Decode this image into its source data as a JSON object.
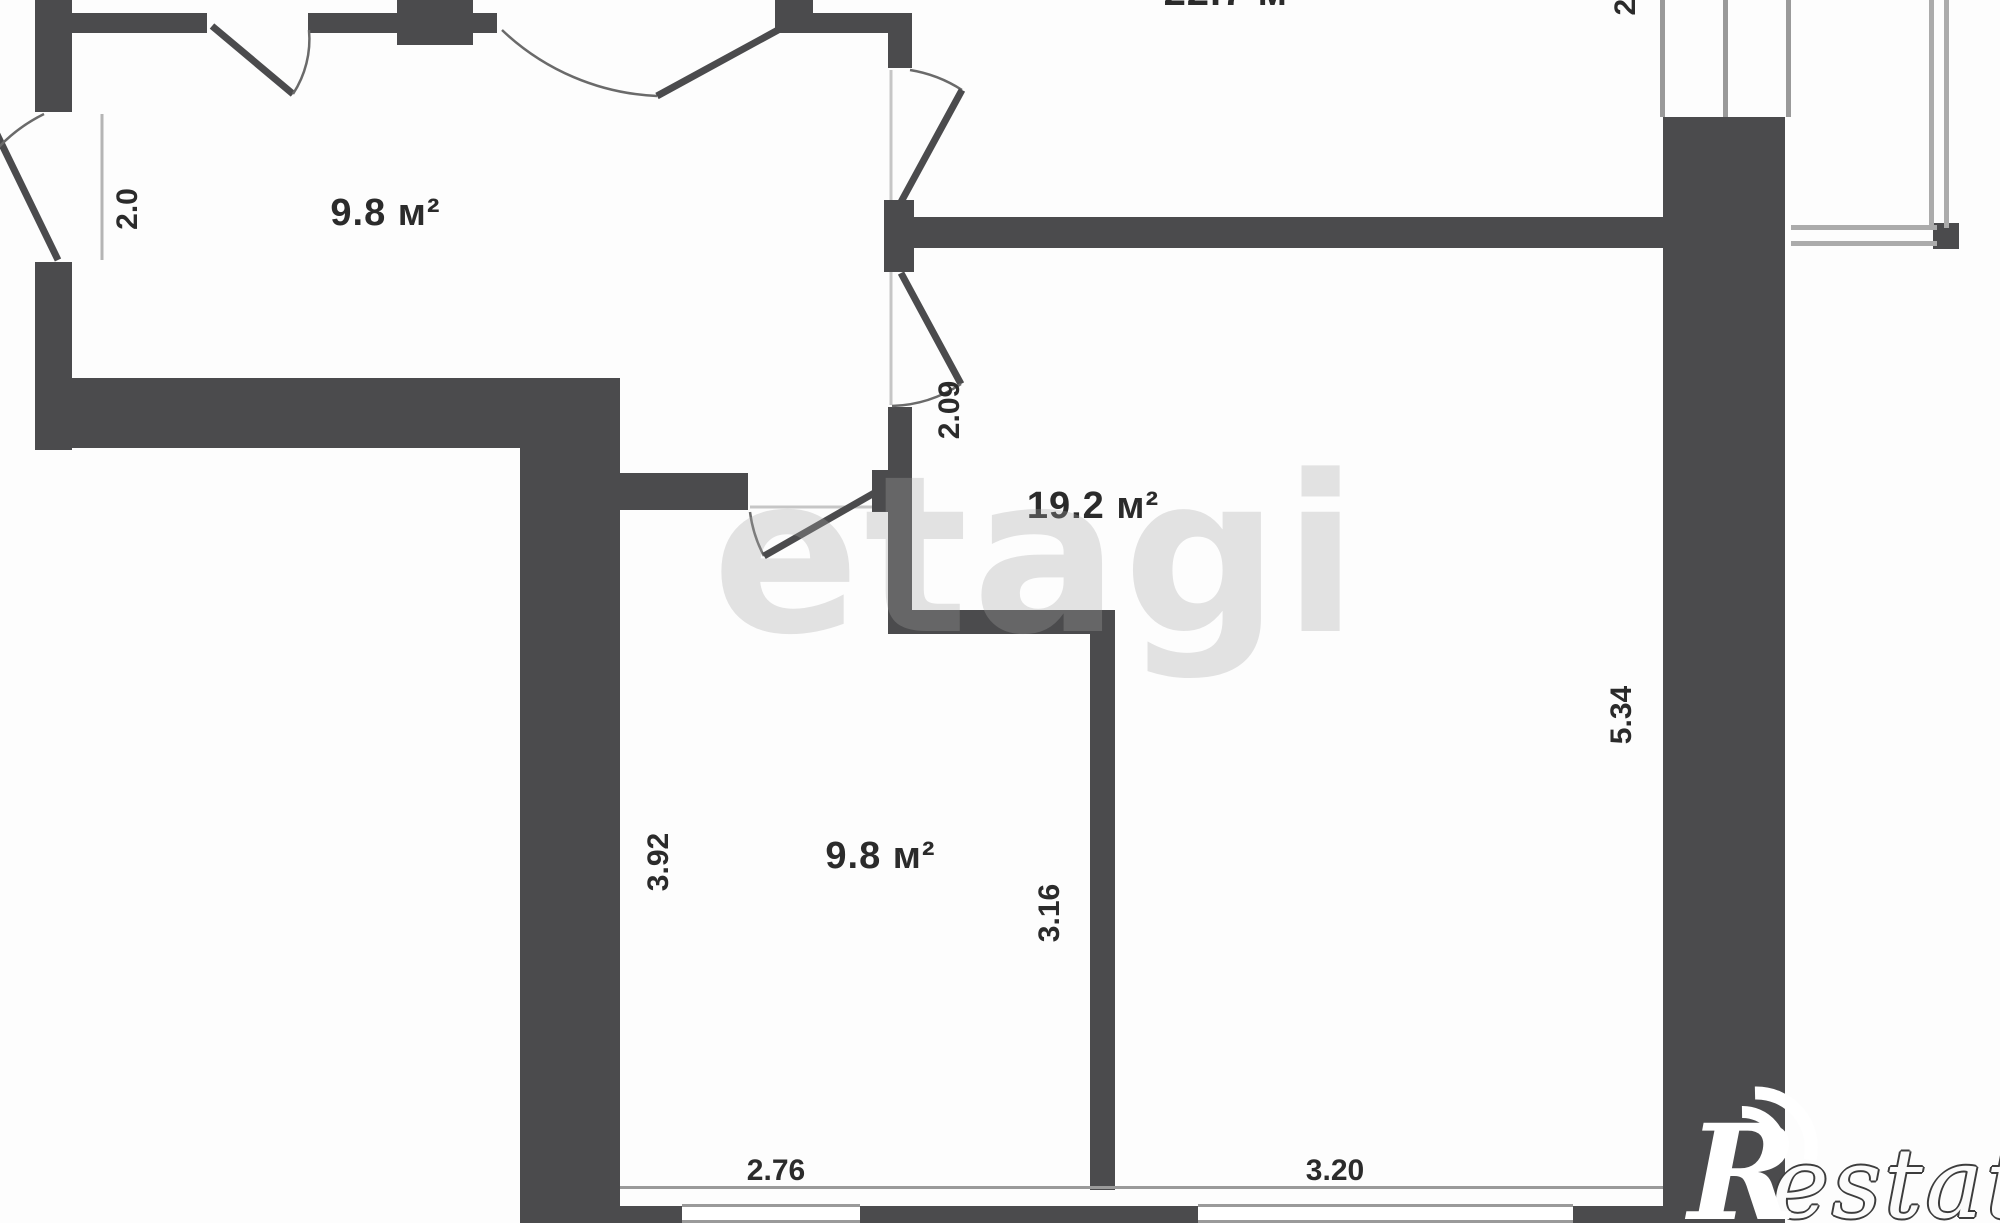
{
  "plan": {
    "type": "apartment-floor-plan",
    "watermark": {
      "text": "etagi"
    },
    "logo": {
      "initial": "R",
      "rest": "estate"
    },
    "rooms": [
      {
        "id": "room-top-left",
        "area_label": "9.8 м²"
      },
      {
        "id": "room-top-right",
        "area_label": "22.7 м²",
        "note": "clipped at top edge of image"
      },
      {
        "id": "room-right",
        "area_label": "19.2 м²"
      },
      {
        "id": "room-bottom",
        "area_label": "9.8 м²"
      }
    ],
    "dimensions": [
      {
        "id": "dim-left-door",
        "value": "2.0",
        "orientation": "vertical"
      },
      {
        "id": "dim-hallway-doors",
        "value": "2.09",
        "orientation": "vertical"
      },
      {
        "id": "dim-bottom-room-depth",
        "value": "3.92",
        "orientation": "vertical"
      },
      {
        "id": "dim-bottom-room-width",
        "value": "2.76",
        "orientation": "horizontal"
      },
      {
        "id": "dim-right-room-inner",
        "value": "3.16",
        "orientation": "vertical"
      },
      {
        "id": "dim-right-room-depth",
        "value": "5.34",
        "orientation": "vertical"
      },
      {
        "id": "dim-right-room-width",
        "value": "3.20",
        "orientation": "horizontal"
      },
      {
        "id": "dim-balcony-partial",
        "value": "2.",
        "orientation": "vertical",
        "note": "clipped at top edge"
      }
    ],
    "colors": {
      "wall": "#4b4b4d",
      "line": "#9a9a9a",
      "text": "#2b2b2b",
      "bg": "#fdfdfd"
    }
  }
}
